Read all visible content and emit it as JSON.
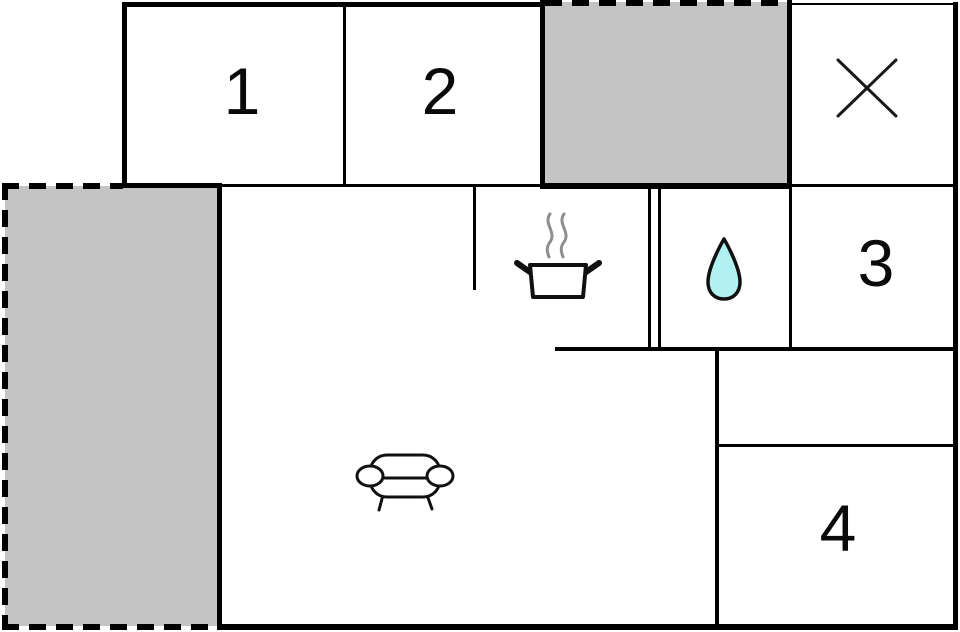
{
  "plan_title": "floor-plan",
  "colors": {
    "wall": "#000000",
    "background": "#ffffff",
    "terrace_fill": "#c4c4c4",
    "water_drop_fill": "#b2f1f2",
    "steam": "#8e8e8e",
    "icon_stroke": "#111111"
  },
  "rooms": [
    {
      "label": "1"
    },
    {
      "label": "2"
    },
    {
      "label": "3"
    },
    {
      "label": "4"
    }
  ],
  "icons": {
    "x_marker": "x-marker-icon",
    "cooking_pot": "cooking-pot-icon",
    "water_drop": "water-drop-icon",
    "sofa": "sofa-icon"
  }
}
